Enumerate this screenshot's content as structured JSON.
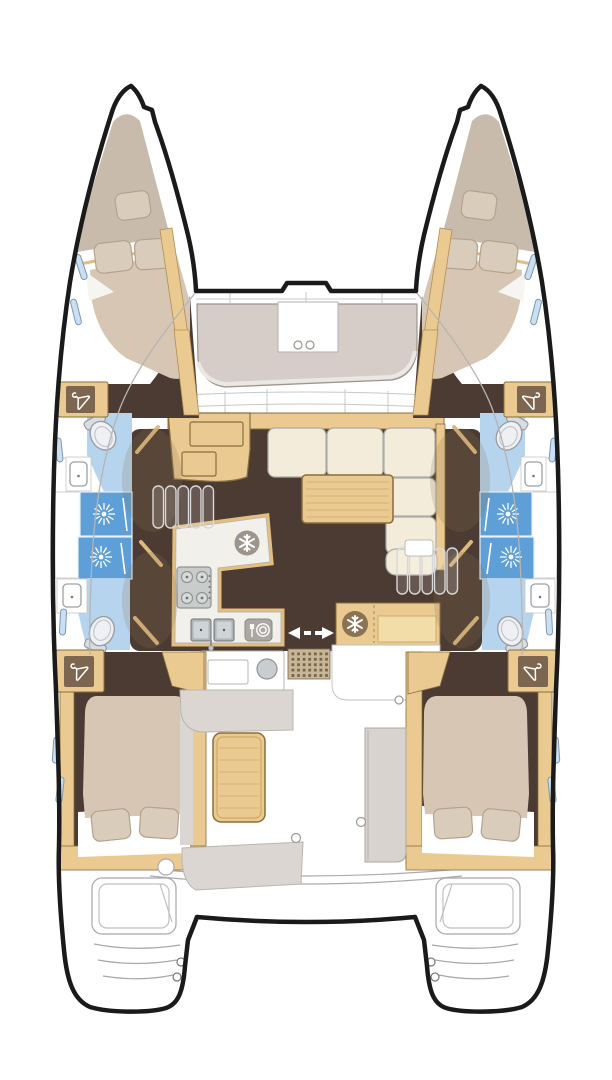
{
  "meta": {
    "title": "Catamaran interior layout plan (top view)",
    "diagram_type": "boat-floor-plan",
    "orientation": "bow at top, twin transoms at bottom"
  },
  "colors": {
    "outline": "#1A1A1A",
    "thin_line": "#ABABAB",
    "grid_line": "#C8C8C8",
    "floor_dark": "#4C3B33",
    "wood": "#EACA90",
    "wood_dark": "#8B6D3C",
    "wood_grain": "#CDA967",
    "wood_panel": "#7C6650",
    "wood_light": "#F2DCA8",
    "bow_beige": "#C9BBAC",
    "mattress": "#D6C6B3",
    "pillow": "#DACCBB",
    "pillow_line": "#B3A28D",
    "cream": "#F3ECDA",
    "cream_line": "#ABACA7",
    "gray_seat": "#D7CDC8",
    "gray_seat_line": "#9C938D",
    "cockpit_gray": "#DCD6D2",
    "module_gray": "#D9D3CF",
    "bath_blue": "#B6D4ED",
    "shower_blue": "#5D9FD6",
    "window_blue": "#C9E0F4",
    "steel": "#C9CCCB",
    "steel_dark": "#8F9594",
    "sink_steel": "#AEB4B8",
    "appliance_gray": "#ABA8A3",
    "fridge_circle": "#9B958C",
    "cooler_circle": "#8A7254",
    "grate_bg": "#C9B694",
    "grate_dot": "#76654F",
    "counter_white": "#F2F0EB",
    "white": "#FFFFFF"
  },
  "hulls": {
    "port": {
      "side": "port (left)",
      "sections": [
        {
          "name": "forepeak-berth",
          "items": [
            "single berth cushion",
            "pillow"
          ]
        },
        {
          "name": "forward-double-cabin",
          "items": [
            "double bed",
            "2 pillows",
            "hull windows"
          ]
        },
        {
          "name": "forward-head",
          "items": [
            "toilet",
            "washbasin",
            "wardrobe"
          ]
        },
        {
          "name": "shower-stalls",
          "items": [
            "shower 1",
            "shower 2"
          ]
        },
        {
          "name": "aft-head",
          "items": [
            "washbasin",
            "toilet",
            "wardrobe"
          ]
        },
        {
          "name": "aft-double-cabin",
          "items": [
            "double bed",
            "2 pillows",
            "wardrobe"
          ]
        }
      ]
    },
    "starboard": {
      "side": "starboard (right)",
      "mirror_of": "port",
      "sections": [
        {
          "name": "forepeak-berth",
          "items": [
            "single berth cushion",
            "pillow"
          ]
        },
        {
          "name": "forward-double-cabin",
          "items": [
            "double bed",
            "2 pillows",
            "hull windows"
          ]
        },
        {
          "name": "forward-head",
          "items": [
            "toilet",
            "washbasin",
            "wardrobe"
          ]
        },
        {
          "name": "shower-stalls",
          "items": [
            "shower 1",
            "shower 2"
          ]
        },
        {
          "name": "aft-head",
          "items": [
            "washbasin",
            "toilet",
            "wardrobe"
          ]
        },
        {
          "name": "aft-double-cabin",
          "items": [
            "double bed",
            "2 pillows",
            "wardrobe"
          ]
        }
      ]
    }
  },
  "saloon": {
    "features": [
      "forward cockpit seat with 2 cup holders",
      "chart desk with panels",
      "L-shaped sofa",
      "dining table",
      "galley: refrigerator, 4-burner stove, double sink, dishwasher",
      "companionway stairs to port hull",
      "companionway stairs to starboard hull",
      "sliding door to cockpit",
      "cooler cabinet"
    ]
  },
  "cockpit": {
    "features": [
      "wet bar with round sink",
      "deck grate",
      "cockpit table",
      "bench seating",
      "aft module",
      "transom swim steps port",
      "transom swim steps starboard"
    ]
  },
  "icons": {
    "hanger": "wardrobe / hanging locker",
    "snowflake": "refrigerator / cooler",
    "sunburst": "shower head",
    "fork-and-plate": "dishwasher",
    "double-arrow": "sliding door direction"
  }
}
